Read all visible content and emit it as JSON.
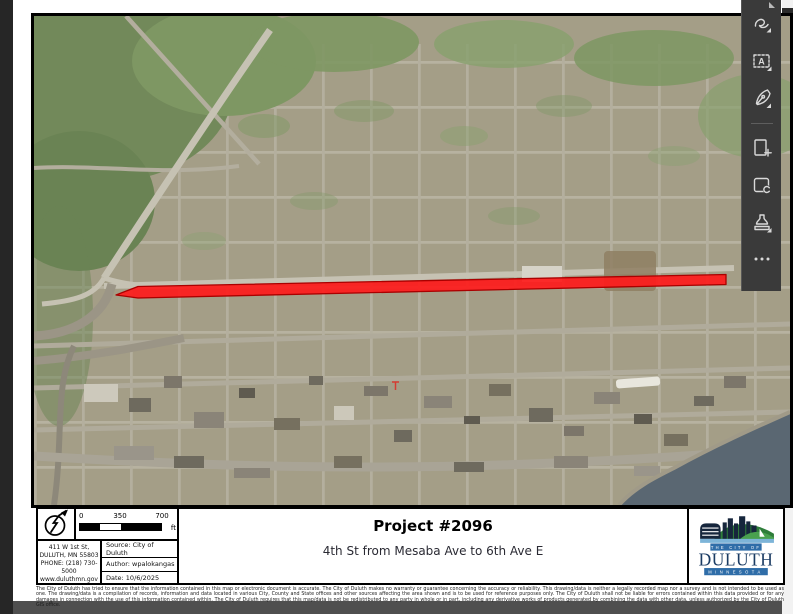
{
  "window": {
    "background": "#4f4f4f",
    "left_strip_color": "#262626",
    "page_color": "#ffffff"
  },
  "toolbar": {
    "bg": "#3a3a3a",
    "icon_color": "#d9d9d9",
    "icons": [
      {
        "name": "draw-icon"
      },
      {
        "name": "add-text-icon"
      },
      {
        "name": "fill-sign-icon"
      },
      {
        "name": "insert-pages-icon"
      },
      {
        "name": "edit-scan-icon"
      },
      {
        "name": "stamp-icon"
      },
      {
        "name": "more-tools-icon"
      }
    ]
  },
  "map": {
    "highlight_color": "#fe1b1b",
    "highlight_outline": "#aa0000",
    "water_color": "#5a6772",
    "forest_color": "#72895a",
    "urban_color": "#a49e87"
  },
  "panel": {
    "scale": {
      "ticks": [
        "0",
        "350",
        "700"
      ],
      "unit": "ft"
    },
    "address": {
      "lines": [
        "411 W 1st St,",
        "DULUTH, MN 55803",
        "PHONE: (218) 730-5000",
        "www.duluthmn.gov"
      ]
    },
    "meta": {
      "source": "Source: City of Duluth",
      "author": "Author: wpalokangas",
      "date": "Date: 10/6/2025"
    },
    "title": "Project #2096",
    "subtitle": "4th St from Mesaba Ave to 6th Ave E",
    "logo": {
      "city_of": "THE CITY OF",
      "name": "DULUTH",
      "state": "MINNESOTA"
    }
  },
  "disclaimer": "The City of Duluth has tried to ensure that the information contained in this map or electronic document is accurate. The City of Duluth makes no warranty or guarantee concerning the accuracy or reliability. This drawing/data is neither a legally recorded map nor a survey and is not intended to be used as one. The drawing/data is a compilation of records, information and data located in various City, County and State offices and other sources affecting the area shown and is to be used for reference purposes only. The City of Duluth shall not be liable for errors contained within this data provided or for any damages in connection with the use of this information contained within. The City of Duluth requires that this map/data is not be redistributed to any party in whole or in part, including any derivative works of products generated by combining the data with other data, unless authorized by the City of Duluth GIS office."
}
